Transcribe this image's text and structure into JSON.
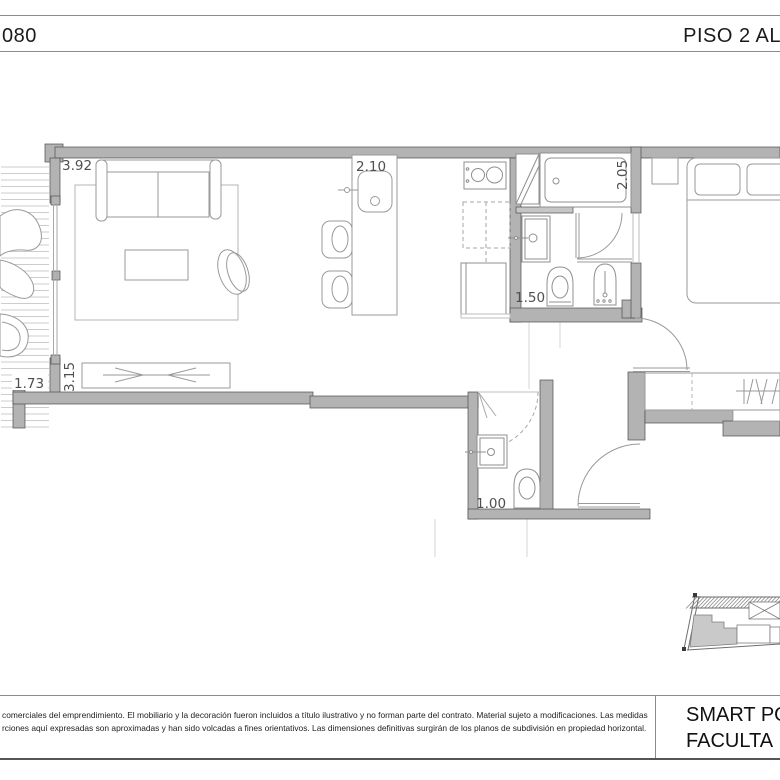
{
  "header": {
    "left_code": "080",
    "right_title": "PISO 2 AL"
  },
  "dimensions": {
    "living_width": "3.92",
    "media_wall": "3.15",
    "balcony_width": "1.73",
    "kitchen_island": "2.10",
    "bathroom_length": "2.05",
    "bathroom_width": "1.50",
    "toilette_width": "1.00"
  },
  "footer": {
    "disclaimer_line1": "comerciales del emprendimiento. El mobiliario y la decoración fueron incluidos a título ilustrativo y no forman parte del contrato. Material sujeto a modificaciones. Las medidas",
    "disclaimer_line2": "rciones aquí expresadas son aproximadas y han sido volcadas a fines orientativos. Las dimensiones definitivas surgirán de los planos de subdivisión en propiedad horizontal.",
    "project_line1": "SMART PO",
    "project_line2": "FACULTA"
  },
  "colors": {
    "wall_fill": "#b3b3b3",
    "wall_edge": "#4e4e4e",
    "furniture_line": "#9a9a9a",
    "dimension_text": "#4f4f4f",
    "keyplan_unit_fill": "#c9c9c9"
  }
}
